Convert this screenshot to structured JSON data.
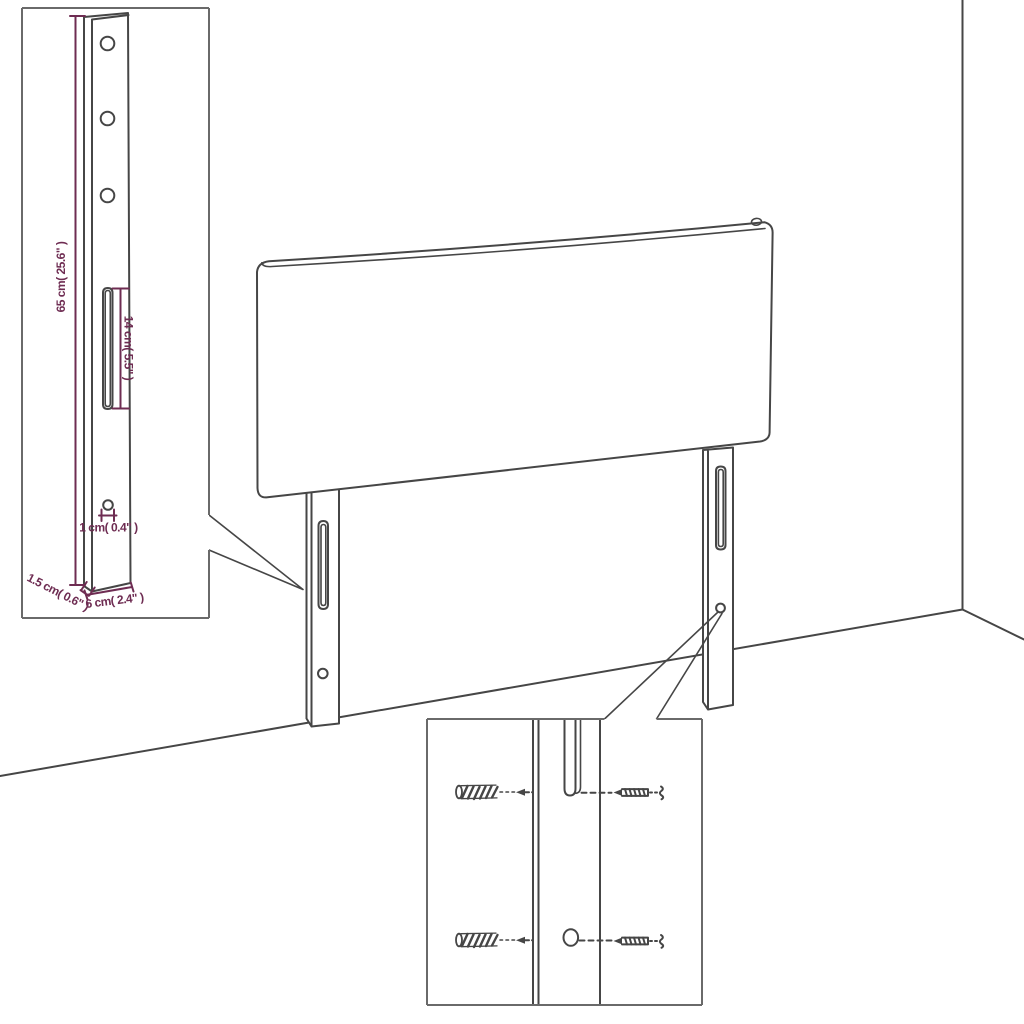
{
  "figure": {
    "type": "furniture-assembly-diagram",
    "subject": "headboard with slotted mounting legs shown against a wall corner, with magnified leg and hardware details",
    "colors": {
      "background": "#ffffff",
      "line": "#464646",
      "inset_border": "#6a6a6a",
      "dimension": "#6e2c52"
    },
    "icons": [
      "wall-plug-icon",
      "screw-icon",
      "mounting-slot",
      "mounting-hole",
      "callout-lines"
    ]
  },
  "leg_detail": {
    "height_label": "65 cm( 25.6\" )",
    "slot_label": "14 cm( 5.5\" )",
    "hole_label": "1 cm( 0.4\" )",
    "thickness_label": "1.5 cm( 0.6\" )",
    "width_label": "6 cm( 2.4\" )"
  }
}
